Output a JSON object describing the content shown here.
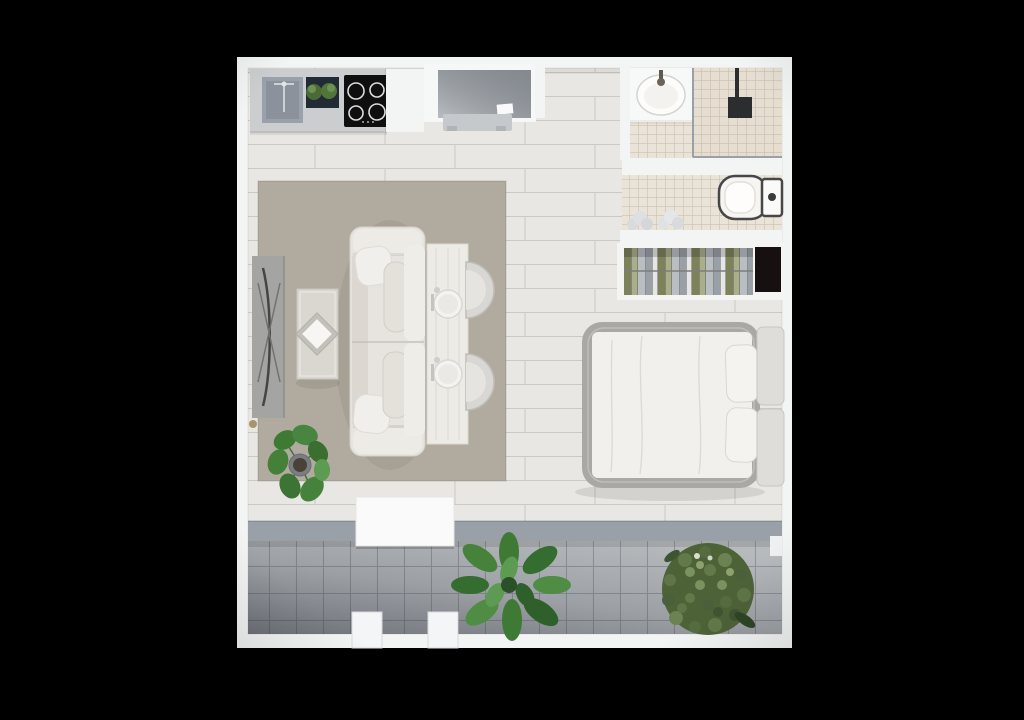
{
  "scene": {
    "type": "floor-plan",
    "view": "top-down-3d-render",
    "rooms": [
      {
        "name": "kitchen",
        "items": [
          "counter",
          "sink",
          "herb-planter",
          "cooktop",
          "upper-cabinet"
        ]
      },
      {
        "name": "work-nook",
        "items": [
          "desk",
          "bench"
        ]
      },
      {
        "name": "bathroom",
        "items": [
          "washbasin",
          "shower",
          "toilet"
        ]
      },
      {
        "name": "sleeping-area",
        "items": [
          "wardrobe",
          "towels",
          "double-bed",
          "pillows",
          "headboard"
        ]
      },
      {
        "name": "living-area",
        "items": [
          "tv-console",
          "coffee-table",
          "sofa",
          "dining-table",
          "plates",
          "chairs",
          "rug",
          "potted-plant"
        ]
      },
      {
        "name": "balcony",
        "items": [
          "door-track",
          "table",
          "plant-left",
          "plant-right",
          "railing-posts"
        ]
      }
    ]
  },
  "colors": {
    "background": "#000000",
    "wall": "#f3f4f4",
    "wood_floor": "#e9e7e3",
    "rug": "#b1ab9f",
    "bath_tile": "#eae4d8",
    "shower_tile": "#e5ded1",
    "balcony_tile": "#b7babd",
    "door_track": "#99a0a8",
    "counter": "#cbcdcf",
    "sink": "#9ba1ab",
    "cooktop": "#0f0f10",
    "desk_top": "#9aa0a7",
    "tv_console": "#a4a4a2",
    "sofa": "#e7e4df",
    "dining_table": "#edebe6",
    "chair": "#d9d7d3",
    "coffee_table": "#dad7d1",
    "bed_frame": "#a9a8a5",
    "mattress": "#f1f0ed",
    "headboard": "#deddd9",
    "wardrobe_cabinet": "#161110",
    "clothes_gray": "#99a0a6",
    "clothes_white": "#e6e6e4",
    "clothes_olive": "#7e8259",
    "clothes_sage": "#aaae8a",
    "clothes_gray2": "#b9bec2",
    "toilet_rim": "#474747",
    "balcony_table": "#fafafa",
    "plant_dark": "#2f5f2b",
    "plant_mid": "#3f7a35",
    "plant_light": "#5d9a52",
    "bush": "#4e6238",
    "pot": "#7b7e80"
  }
}
